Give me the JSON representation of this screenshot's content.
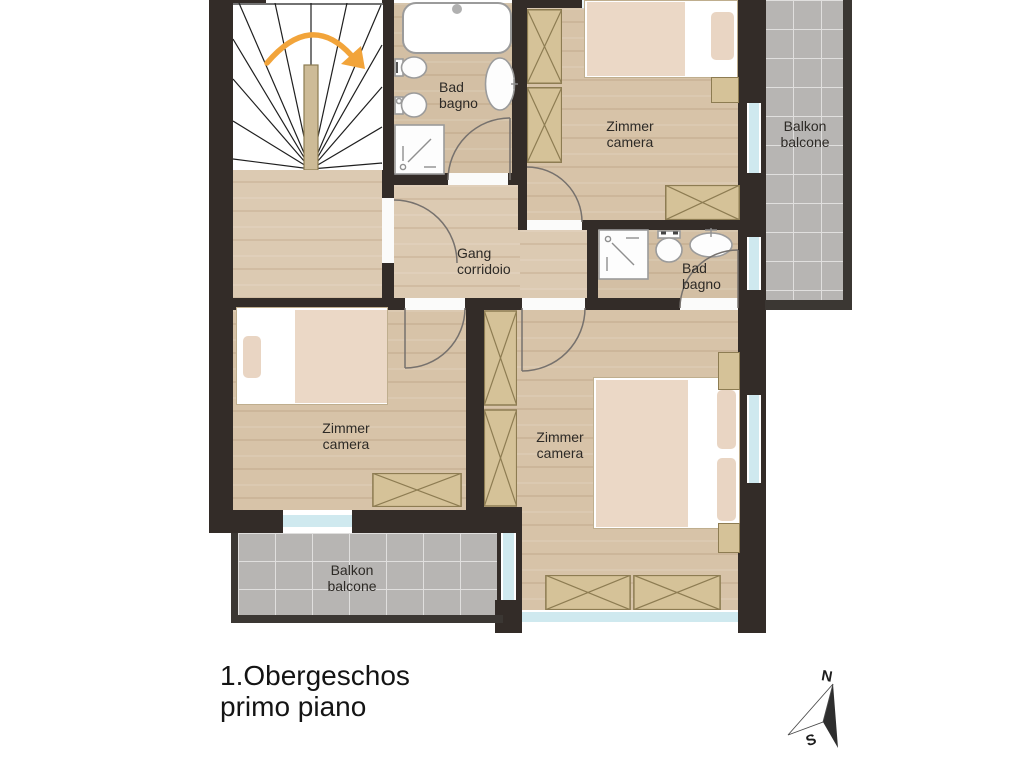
{
  "title": {
    "line1": "1.Obergeschos",
    "line2": "primo piano"
  },
  "rooms": {
    "bath_top": {
      "name_de": "Bad",
      "name_it": "bagno"
    },
    "bedroom_top": {
      "name_de": "Zimmer",
      "name_it": "camera"
    },
    "balcony_right": {
      "name_de": "Balkon",
      "name_it": "balcone"
    },
    "corridor": {
      "name_de": "Gang",
      "name_it": "corridoio"
    },
    "bath_right": {
      "name_de": "Bad",
      "name_it": "bagno"
    },
    "bedroom_left": {
      "name_de": "Zimmer",
      "name_it": "camera"
    },
    "bedroom_bottom": {
      "name_de": "Zimmer",
      "name_it": "camera"
    },
    "balcony_bottom": {
      "name_de": "Balkon",
      "name_it": "balcone"
    }
  },
  "compass": {
    "north": "N",
    "south": "S"
  },
  "icons": {
    "compass-icon": "north-needle",
    "stair-direction-arrow-icon": "orange-curved-arrow",
    "bathtub-icon": "rounded-rect-tub",
    "toilet-icon": "oval-bowl-with-tank",
    "bidet-icon": "oval-bowl",
    "sink-icon": "oval-basin-with-tap",
    "shower-icon": "square-tray-with-drain"
  },
  "colors": {
    "wall": "#332c28",
    "floor_wood": "#d8c5ac",
    "balcony_tile": "#b7b5b3",
    "window_glass": "#cfe9ef",
    "furniture": "#d5c298",
    "stair_arrow": "#f2a43a"
  }
}
